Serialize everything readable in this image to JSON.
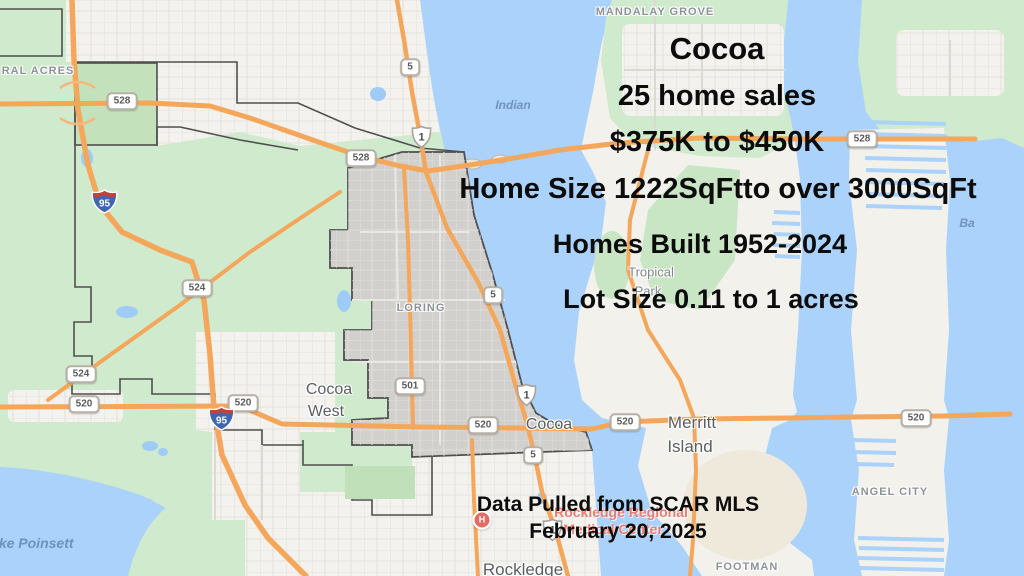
{
  "overlay": {
    "title": "Cocoa",
    "stats": [
      "25 home sales",
      "$375K to $450K",
      "Home Size 1222SqFtto over 3000SqFt",
      "Homes Built 1952-2024",
      "Lot Size 0.11 to 1 acres"
    ],
    "footer": [
      "Data Pulled from SCAR MLS",
      "February 20, 2025"
    ],
    "text_color": "#0c0c0c"
  },
  "map": {
    "hospital_icon_letter": "H",
    "labels": [
      {
        "text": "MANDALAY GROVE",
        "kind": "area",
        "x": 655,
        "y": 12
      },
      {
        "text": "RAL ACRES",
        "kind": "area",
        "x": 38,
        "y": 71
      },
      {
        "text": "Indian",
        "kind": "water",
        "x": 513,
        "y": 105
      },
      {
        "text": "Ba",
        "kind": "water",
        "x": 967,
        "y": 223
      },
      {
        "text": "Tropical",
        "kind": "sub",
        "x": 651,
        "y": 272
      },
      {
        "text": "Park",
        "kind": "sub",
        "x": 648,
        "y": 291
      },
      {
        "text": "LORING",
        "kind": "area",
        "x": 421,
        "y": 308
      },
      {
        "text": "Cocoa",
        "kind": "city",
        "x": 329,
        "y": 390
      },
      {
        "text": "West",
        "kind": "city",
        "x": 326,
        "y": 412
      },
      {
        "text": "Cocoa",
        "kind": "city",
        "x": 549,
        "y": 425
      },
      {
        "text": "Merritt",
        "kind": "city-lg",
        "x": 692,
        "y": 423
      },
      {
        "text": "Island",
        "kind": "city-lg",
        "x": 690,
        "y": 447
      },
      {
        "text": "ANGEL CITY",
        "kind": "area",
        "x": 890,
        "y": 492
      },
      {
        "text": "FOOTMAN",
        "kind": "area",
        "x": 747,
        "y": 567
      },
      {
        "text": "Rockledge",
        "kind": "city-lg",
        "x": 523,
        "y": 570
      },
      {
        "text": "Lake Poinsett",
        "kind": "water-lg",
        "x": 28,
        "y": 543
      },
      {
        "text": "Rockledge Regional",
        "kind": "poi",
        "x": 621,
        "y": 512
      },
      {
        "text": "Medical Center",
        "kind": "poi",
        "x": 613,
        "y": 529
      }
    ],
    "shields": [
      {
        "label": "528",
        "type": "fl",
        "x": 122,
        "y": 101
      },
      {
        "label": "528",
        "type": "fl",
        "x": 361,
        "y": 158
      },
      {
        "label": "528",
        "type": "fl",
        "x": 862,
        "y": 139
      },
      {
        "label": "524",
        "type": "fl",
        "x": 197,
        "y": 288
      },
      {
        "label": "524",
        "type": "fl",
        "x": 81,
        "y": 374
      },
      {
        "label": "520",
        "type": "fl",
        "x": 84,
        "y": 404
      },
      {
        "label": "520",
        "type": "fl",
        "x": 243,
        "y": 403
      },
      {
        "label": "520",
        "type": "fl",
        "x": 483,
        "y": 425
      },
      {
        "label": "520",
        "type": "fl",
        "x": 625,
        "y": 422
      },
      {
        "label": "520",
        "type": "fl",
        "x": 916,
        "y": 418
      },
      {
        "label": "501",
        "type": "fl",
        "x": 410,
        "y": 386
      },
      {
        "label": "5",
        "type": "fl",
        "x": 410,
        "y": 67
      },
      {
        "label": "5",
        "type": "fl",
        "x": 493,
        "y": 295
      },
      {
        "label": "5",
        "type": "fl",
        "x": 533,
        "y": 455
      },
      {
        "label": "1",
        "type": "us",
        "x": 410,
        "y": 125
      },
      {
        "label": "1",
        "type": "us",
        "x": 515,
        "y": 383
      },
      {
        "label": "1",
        "type": "us",
        "x": 541,
        "y": 518
      },
      {
        "label": "95",
        "type": "interstate",
        "x": 91,
        "y": 189
      },
      {
        "label": "95",
        "type": "interstate",
        "x": 208,
        "y": 406
      }
    ],
    "colors": {
      "water": "#aad2fa",
      "vegetation": "#cfeacc",
      "urban": "#f4f2ee",
      "city_highlight_fill": "#d2d0cc",
      "city_boundary": "#4f4f4f",
      "highway_orange": "#f4a65a",
      "poi_red": "#ee7b72",
      "label_gray": "#8d9297"
    }
  }
}
